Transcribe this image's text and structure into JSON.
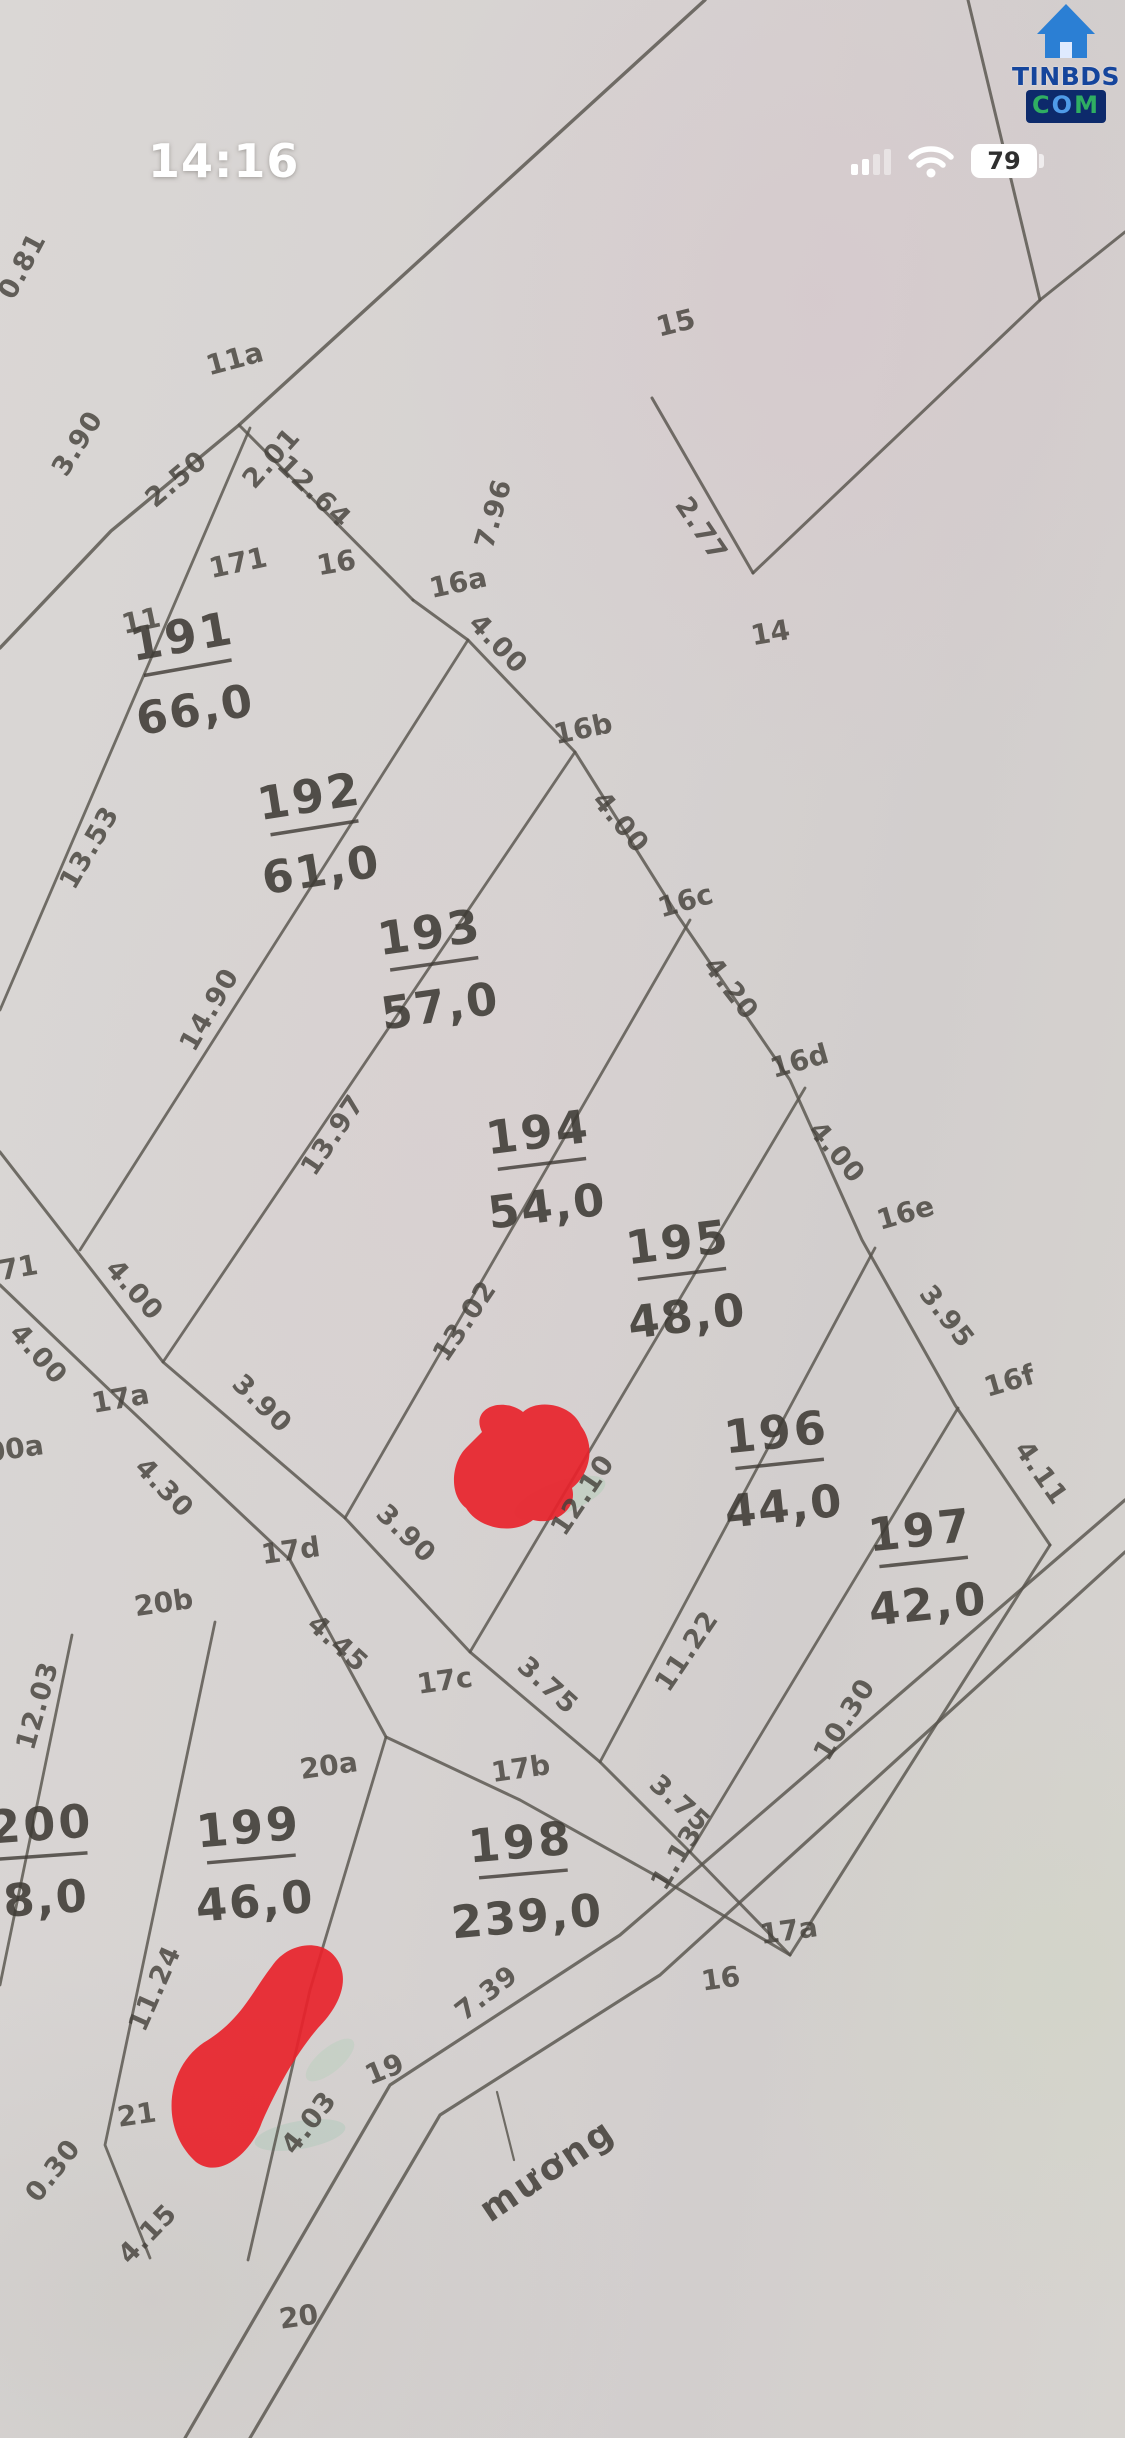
{
  "status_bar": {
    "time": "14:16",
    "battery_percent": "79"
  },
  "logo": {
    "line1": "TINBDS",
    "com_letters": [
      "C",
      "O",
      "M"
    ]
  },
  "map": {
    "annotation": {
      "t": "mương",
      "x": 554,
      "y": 2180,
      "r": -34
    },
    "parcels": [
      {
        "id": "191",
        "area": "66,0",
        "x": 185,
        "y": 652,
        "r": -10
      },
      {
        "id": "192",
        "area": "61,0",
        "x": 312,
        "y": 812,
        "r": -9
      },
      {
        "id": "193",
        "area": "57,0",
        "x": 432,
        "y": 948,
        "r": -8
      },
      {
        "id": "194",
        "area": "54,0",
        "x": 540,
        "y": 1148,
        "r": -7
      },
      {
        "id": "195",
        "area": "48,0",
        "x": 680,
        "y": 1258,
        "r": -7
      },
      {
        "id": "196",
        "area": "44,0",
        "x": 778,
        "y": 1448,
        "r": -6
      },
      {
        "id": "197",
        "area": "42,0",
        "x": 922,
        "y": 1546,
        "r": -6
      },
      {
        "id": "198",
        "area": "239,0",
        "x": 522,
        "y": 1858,
        "r": -5
      },
      {
        "id": "199",
        "area": "46,0",
        "x": 250,
        "y": 1843,
        "r": -5
      },
      {
        "id": "200",
        "area": "8,0",
        "x": 42,
        "y": 1840,
        "r": -4
      }
    ],
    "point_labels": [
      {
        "t": "11a",
        "x": 237,
        "y": 368,
        "r": -15
      },
      {
        "t": "11",
        "x": 143,
        "y": 630,
        "r": -12
      },
      {
        "t": "171",
        "x": 240,
        "y": 572,
        "r": -12
      },
      {
        "t": "15",
        "x": 678,
        "y": 332,
        "r": -14
      },
      {
        "t": "14",
        "x": 772,
        "y": 642,
        "r": -10
      },
      {
        "t": "16",
        "x": 338,
        "y": 572,
        "r": -10
      },
      {
        "t": "16a",
        "x": 460,
        "y": 592,
        "r": -12
      },
      {
        "t": "16b",
        "x": 585,
        "y": 738,
        "r": -12
      },
      {
        "t": "16c",
        "x": 688,
        "y": 910,
        "r": -16
      },
      {
        "t": "16d",
        "x": 802,
        "y": 1070,
        "r": -16
      },
      {
        "t": "16e",
        "x": 908,
        "y": 1222,
        "r": -16
      },
      {
        "t": "16f",
        "x": 1012,
        "y": 1390,
        "r": -16
      },
      {
        "t": "17a",
        "x": 122,
        "y": 1408,
        "r": -10
      },
      {
        "t": "17d",
        "x": 292,
        "y": 1560,
        "r": -8
      },
      {
        "t": "17c",
        "x": 446,
        "y": 1690,
        "r": -8
      },
      {
        "t": "17b",
        "x": 522,
        "y": 1778,
        "r": -8
      },
      {
        "t": "17a",
        "x": 790,
        "y": 1940,
        "r": -8,
        "c": "#55705a"
      },
      {
        "t": "16",
        "x": 722,
        "y": 1988,
        "r": -8
      },
      {
        "t": "20b",
        "x": 165,
        "y": 1612,
        "r": -8
      },
      {
        "t": "20a",
        "x": 330,
        "y": 1775,
        "r": -8
      },
      {
        "t": "71",
        "x": 20,
        "y": 1277,
        "r": -10
      },
      {
        "t": "00a",
        "x": 16,
        "y": 1458,
        "r": -8
      },
      {
        "t": "21",
        "x": 138,
        "y": 2124,
        "r": -8
      },
      {
        "t": "19",
        "x": 388,
        "y": 2078,
        "r": -22
      },
      {
        "t": "20",
        "x": 300,
        "y": 2326,
        "r": -8
      }
    ],
    "edge_labels": [
      {
        "t": "0.81",
        "x": 30,
        "y": 270,
        "r": -62
      },
      {
        "t": "3.90",
        "x": 85,
        "y": 448,
        "r": -58
      },
      {
        "t": "2.50",
        "x": 182,
        "y": 486,
        "r": -40
      },
      {
        "t": "2.01",
        "x": 278,
        "y": 464,
        "r": -48
      },
      {
        "t": "7.96",
        "x": 502,
        "y": 516,
        "r": -74
      },
      {
        "t": "2.77",
        "x": 694,
        "y": 534,
        "r": 56
      },
      {
        "t": "12.64",
        "x": 308,
        "y": 498,
        "r": 44
      },
      {
        "t": "4.00",
        "x": 492,
        "y": 650,
        "r": 46
      },
      {
        "t": "4.00",
        "x": 614,
        "y": 828,
        "r": 50
      },
      {
        "t": "4.20",
        "x": 724,
        "y": 994,
        "r": 52
      },
      {
        "t": "4.00",
        "x": 830,
        "y": 1158,
        "r": 50
      },
      {
        "t": "3.95",
        "x": 940,
        "y": 1322,
        "r": 52
      },
      {
        "t": "4.11",
        "x": 1034,
        "y": 1478,
        "r": 55
      },
      {
        "t": "13.53",
        "x": 97,
        "y": 852,
        "r": -60
      },
      {
        "t": "14.90",
        "x": 217,
        "y": 1014,
        "r": -60
      },
      {
        "t": "13.97",
        "x": 340,
        "y": 1140,
        "r": -56
      },
      {
        "t": "13.02",
        "x": 472,
        "y": 1326,
        "r": -56
      },
      {
        "t": "12.10",
        "x": 590,
        "y": 1500,
        "r": -56
      },
      {
        "t": "11.22",
        "x": 694,
        "y": 1656,
        "r": -56
      },
      {
        "t": "10.30",
        "x": 852,
        "y": 1724,
        "r": -58
      },
      {
        "t": "4.00",
        "x": 128,
        "y": 1296,
        "r": 48
      },
      {
        "t": "4.00",
        "x": 32,
        "y": 1360,
        "r": 48
      },
      {
        "t": "4.30",
        "x": 158,
        "y": 1494,
        "r": 46
      },
      {
        "t": "3.90",
        "x": 256,
        "y": 1410,
        "r": 44
      },
      {
        "t": "3.90",
        "x": 400,
        "y": 1540,
        "r": 44
      },
      {
        "t": "4.45",
        "x": 332,
        "y": 1650,
        "r": 42
      },
      {
        "t": "3.75",
        "x": 542,
        "y": 1692,
        "r": 42
      },
      {
        "t": "3.75",
        "x": 674,
        "y": 1810,
        "r": 42
      },
      {
        "t": "1.13",
        "x": 684,
        "y": 1862,
        "r": -58
      },
      {
        "t": "12.03",
        "x": 46,
        "y": 1708,
        "r": -74
      },
      {
        "t": "11.24",
        "x": 163,
        "y": 1992,
        "r": -66
      },
      {
        "t": "4.03",
        "x": 316,
        "y": 2128,
        "r": -52,
        "c": "#3e6148"
      },
      {
        "t": "7.39",
        "x": 492,
        "y": 2000,
        "r": -38
      },
      {
        "t": "0.30",
        "x": 60,
        "y": 2176,
        "r": -52
      },
      {
        "t": "4.15",
        "x": 154,
        "y": 2240,
        "r": -46
      }
    ],
    "lines": [
      {
        "n": "road-top",
        "p": "705,0 239,425 111,531 0,648",
        "w": 3.4
      },
      {
        "n": "edge-12-64",
        "p": "239,425 413,600",
        "w": 3
      },
      {
        "n": "boundary-16-zigzag",
        "p": "413,600 468,640 575,752 678,916 790,1080 862,1240 955,1405 1050,1545",
        "w": 3
      },
      {
        "n": "edge-10-30",
        "p": "1050,1545 790,1955",
        "w": 3
      },
      {
        "n": "zigzag-15-left",
        "p": "652,398 753,573",
        "w": 3
      },
      {
        "n": "zigzag-15-right",
        "p": "753,573 1040,300 1125,232",
        "w": 3
      },
      {
        "n": "line-top-right",
        "p": "968,0 1040,300",
        "w": 3
      },
      {
        "n": "division-191",
        "p": "250,428 0,1010",
        "w": 2.8
      },
      {
        "n": "division-192",
        "p": "468,640 80,1250",
        "w": 2.8
      },
      {
        "n": "division-193",
        "p": "575,752 163,1362",
        "w": 2.8
      },
      {
        "n": "division-194",
        "p": "690,920 345,1518",
        "w": 2.8
      },
      {
        "n": "division-195",
        "p": "805,1088 470,1652",
        "w": 2.8
      },
      {
        "n": "division-196",
        "p": "875,1248 600,1762",
        "w": 2.8
      },
      {
        "n": "division-197",
        "p": "958,1408 690,1852",
        "w": 2.8
      },
      {
        "n": "road-17-upper",
        "p": "0,1152 163,1362 345,1518 470,1652 600,1762 690,1852 790,1955",
        "w": 3
      },
      {
        "n": "road-17-lower",
        "p": "0,1285 120,1400 290,1560 386,1737 520,1800 660,1878 790,1955",
        "w": 3
      },
      {
        "n": "division-198-199",
        "p": "386,1737 310,1990 248,2260",
        "w": 2.8
      },
      {
        "n": "division-199-200",
        "p": "215,1622 105,2145 150,2258",
        "w": 2.8
      },
      {
        "n": "division-200-left",
        "p": "72,1635 0,1985",
        "w": 2.8
      },
      {
        "n": "canal-upper",
        "p": "185,2438 390,2085 620,1935 1125,1500",
        "w": 3.2
      },
      {
        "n": "canal-lower",
        "p": "250,2438 440,2115 660,1975 1125,1552",
        "w": 3.2
      },
      {
        "n": "muong-leader",
        "p": "497,2092 514,2160",
        "w": 2.2
      }
    ],
    "red_marks": [
      {
        "n": "red-mark-upper",
        "d": "M482,1432 C470,1408 502,1396 523,1412 C538,1398 572,1404 581,1426 C596,1446 590,1474 572,1488 C578,1508 556,1526 533,1520 C512,1536 478,1528 466,1508 C448,1494 452,1462 466,1448 Z"
      },
      {
        "n": "red-mark-lower",
        "d": "M196,2162 C158,2128 166,2064 208,2040 C242,2018 252,1992 272,1966 C288,1942 322,1938 336,1958 C352,1980 338,2008 318,2028 C296,2054 278,2086 262,2122 C252,2152 220,2180 196,2162 Z"
      }
    ],
    "highlight_smudges": [
      {
        "n": "green-smudge-1",
        "cx": 560,
        "cy": 1498,
        "rx": 48,
        "ry": 16,
        "rot": -20,
        "f": "#a9cdb4",
        "o": 0.38
      },
      {
        "n": "green-smudge-2",
        "cx": 330,
        "cy": 2060,
        "rx": 30,
        "ry": 12,
        "rot": -40,
        "f": "#a9cdb4",
        "o": 0.3
      },
      {
        "n": "green-smudge-3",
        "cx": 300,
        "cy": 2135,
        "rx": 46,
        "ry": 14,
        "rot": -10,
        "f": "#9cc8b0",
        "o": 0.3
      }
    ]
  }
}
